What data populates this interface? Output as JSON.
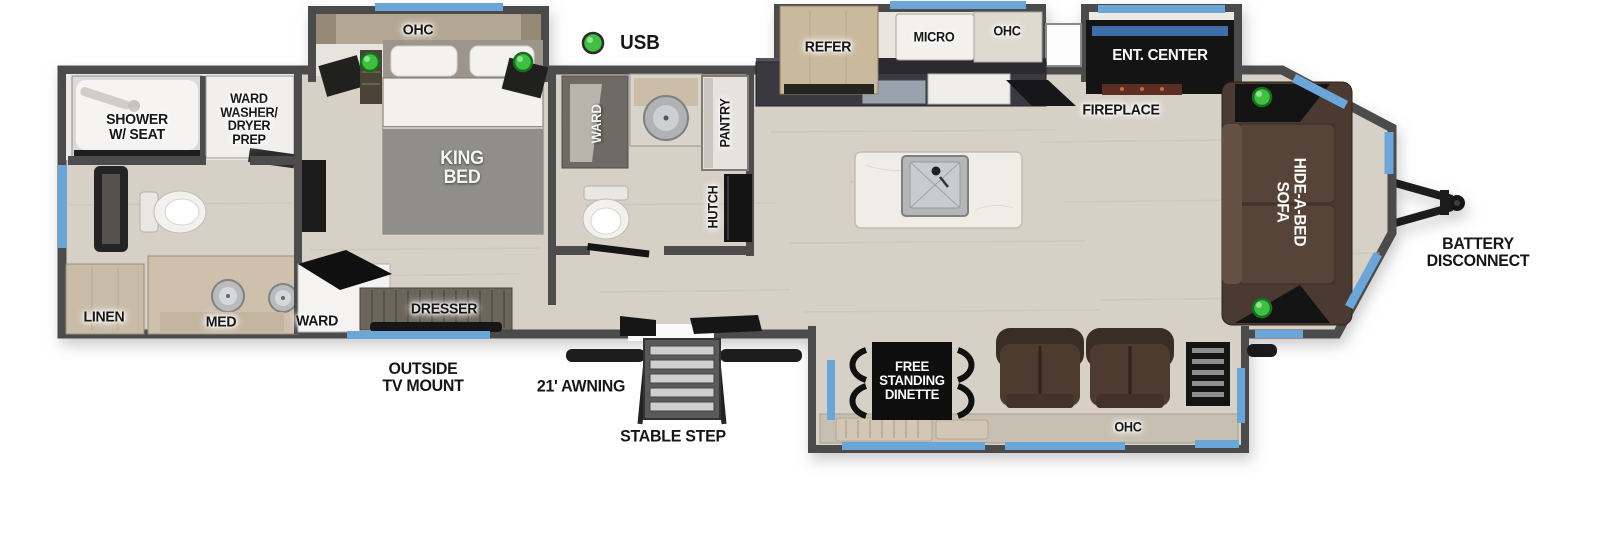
{
  "colors": {
    "wall": "#4c4c4c",
    "floor_wood": "#d7d0c6",
    "window_blue": "#6ca6d9",
    "usb_green": "#3fbf44",
    "label_dark": "#161616",
    "sofa_brown": "#4a3a31",
    "cabinet_tan": "#c9b99d",
    "black_furniture": "#141414"
  },
  "legend": {
    "usb": "USB"
  },
  "rooms": {
    "rear_bath": {
      "shower": "SHOWER\nW/ SEAT",
      "ward_washer_dryer_prep": "WARD\nWASHER/\nDRYER\nPREP",
      "linen": "LINEN",
      "med": "MED"
    },
    "bedroom": {
      "ohc": "OHC",
      "king_bed": "KING\nBED",
      "ward": "WARD",
      "dresser": "DRESSER"
    },
    "mid_bath": {
      "ward": "WARD",
      "pantry": "PANTRY",
      "hutch": "HUTCH"
    },
    "kitchen": {
      "refer": "REFER",
      "micro": "MICRO",
      "ohc": "OHC"
    },
    "living": {
      "ent_center": "ENT. CENTER",
      "fireplace": "FIREPLACE",
      "hide_a_bed_sofa": "HIDE-A-BED\nSOFA",
      "free_standing_dinette": "FREE\nSTANDING\nDINETTE",
      "ohc": "OHC"
    }
  },
  "exterior": {
    "battery_disconnect": "BATTERY\nDISCONNECT",
    "outside_tv_mount": "OUTSIDE\nTV MOUNT",
    "awning_21": "21' AWNING",
    "stable_step": "STABLE STEP"
  }
}
